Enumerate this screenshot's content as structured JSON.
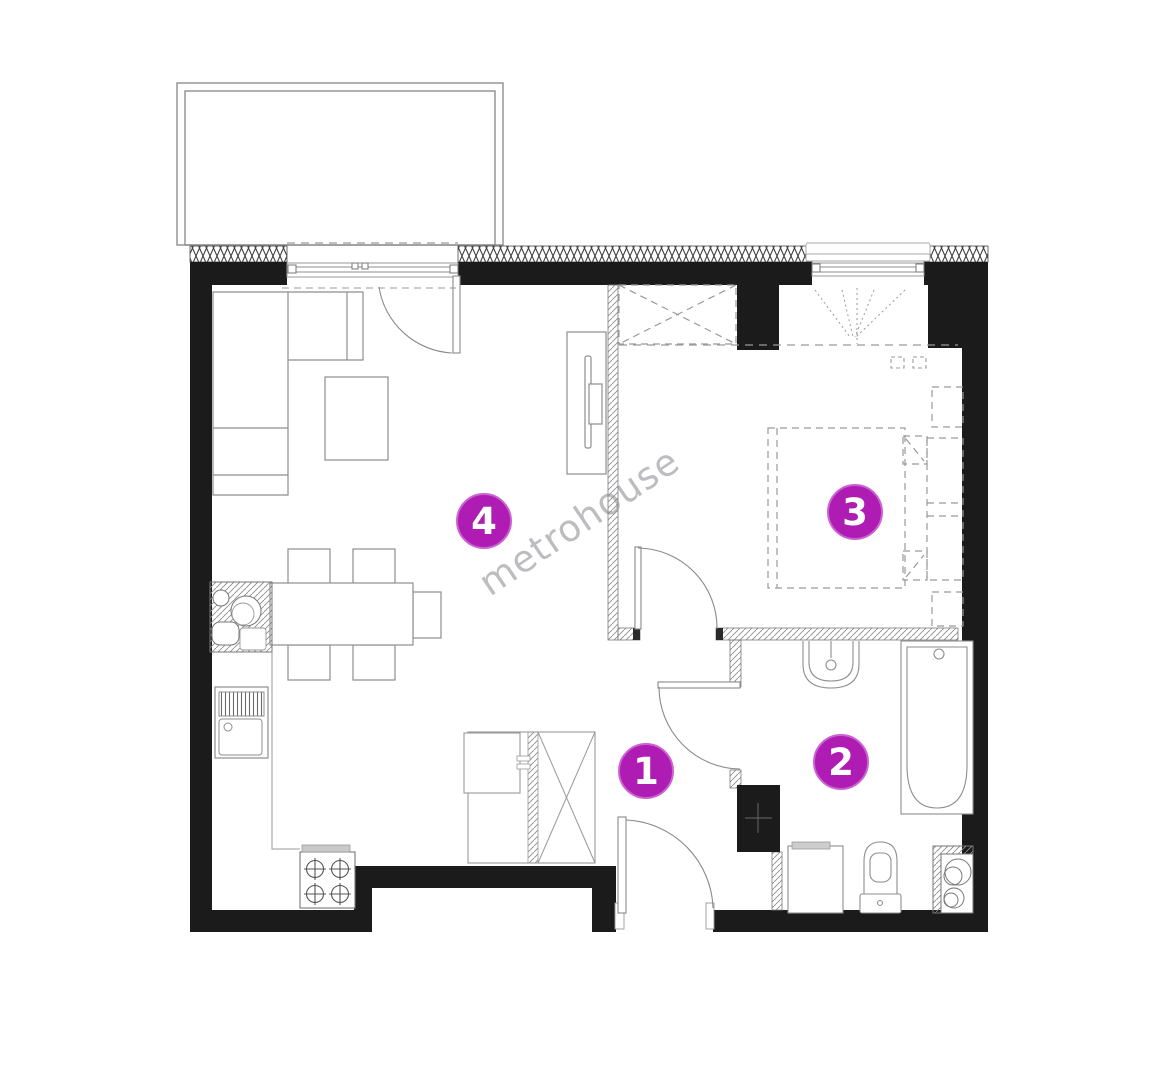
{
  "plan": {
    "watermark_text": "metrohouse",
    "markers": [
      {
        "label": "1"
      },
      {
        "label": "2"
      },
      {
        "label": "3"
      },
      {
        "label": "4"
      }
    ],
    "colors": {
      "marker_fill": "#ae1cb4",
      "marker_text": "#ffffff",
      "wall": "#1b1b1b",
      "drawing_line": "#8e8e8e",
      "watermark": "#8d8f93"
    }
  }
}
